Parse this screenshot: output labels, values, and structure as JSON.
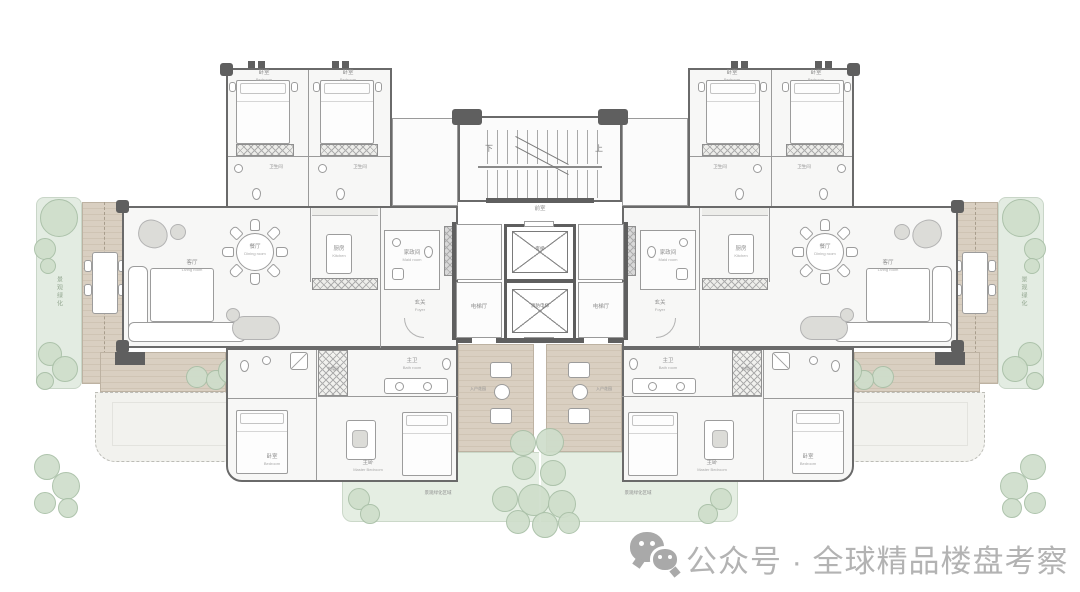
{
  "meta": {
    "type": "residential-tower-floor-plan",
    "footer": {
      "wechat_label": "公众号 · 全球精品楼盘考察"
    }
  },
  "rooms": {
    "living": {
      "zh": "客厅",
      "en": "Living room"
    },
    "dining": {
      "zh": "餐厅",
      "en": "Dining room"
    },
    "kitchen": {
      "zh": "厨房",
      "en": "Kitchen"
    },
    "bedroom": {
      "zh": "卧室",
      "en": "Bedroom"
    },
    "master": {
      "zh": "主卧",
      "en": "Master Bedroom"
    },
    "master_bath": {
      "zh": "主卫",
      "en": "Bath room"
    },
    "bath": {
      "zh": "卫生间",
      "en": "Bath room"
    },
    "cloak": {
      "zh": "衣帽间",
      "en": "Cloak room"
    },
    "foyer": {
      "zh": "玄关",
      "en": "Foyer"
    },
    "maid": {
      "zh": "家政间",
      "en": "Maid room"
    }
  },
  "core": {
    "stair_up": "上",
    "stair_down": "下",
    "vestibule": "前室",
    "passenger_lift": "客梯",
    "fire_lift": "消防电梯",
    "lift_hall": "电梯厅"
  },
  "landscape": {
    "strip": "景观绿化",
    "entry_garden": "入户花园",
    "garden_area": "景观绿化区域"
  },
  "colors": {
    "wall": "#5f5f5f",
    "deck": "#d9cfc1",
    "green": "#e5eee3",
    "tree": "#cfdecb",
    "label_text": "#8f8f8f",
    "watermark": "#b3b3b3"
  }
}
